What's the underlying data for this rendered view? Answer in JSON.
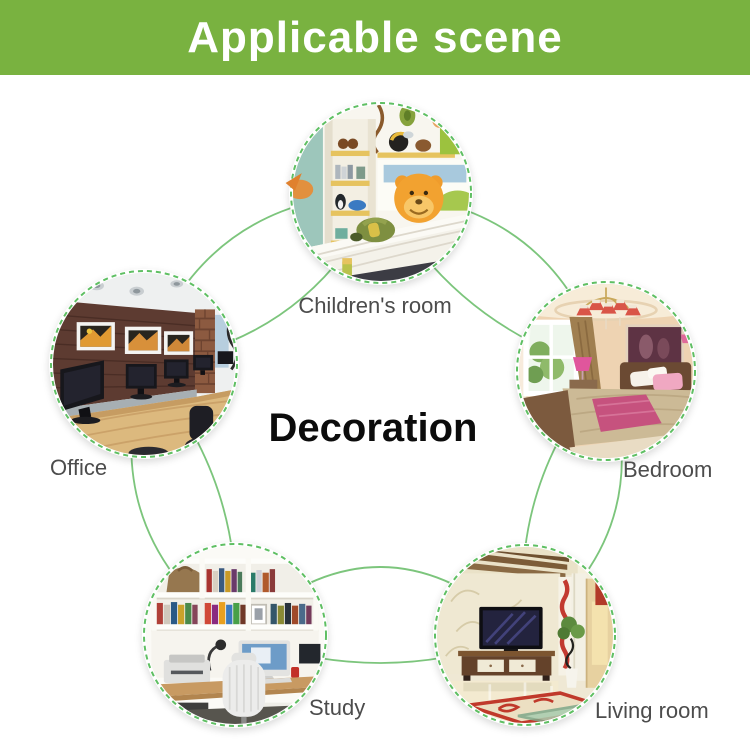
{
  "banner": {
    "title": "Applicable scene"
  },
  "center": {
    "label": "Decoration"
  },
  "scenes": [
    {
      "id": "children-room",
      "label": "Children's room"
    },
    {
      "id": "office",
      "label": "Office"
    },
    {
      "id": "bedroom",
      "label": "Bedroom"
    },
    {
      "id": "study",
      "label": "Study"
    },
    {
      "id": "living-room",
      "label": "Living room"
    }
  ],
  "colors": {
    "banner_green": "#79b240",
    "banner_text": "#ffffff",
    "connector_green": "#7cc57c",
    "ring_green": "#5fbf63",
    "arrow_orange": "#e0812e",
    "label_gray": "#4c4c4c",
    "center_text": "#0c0c0c"
  }
}
